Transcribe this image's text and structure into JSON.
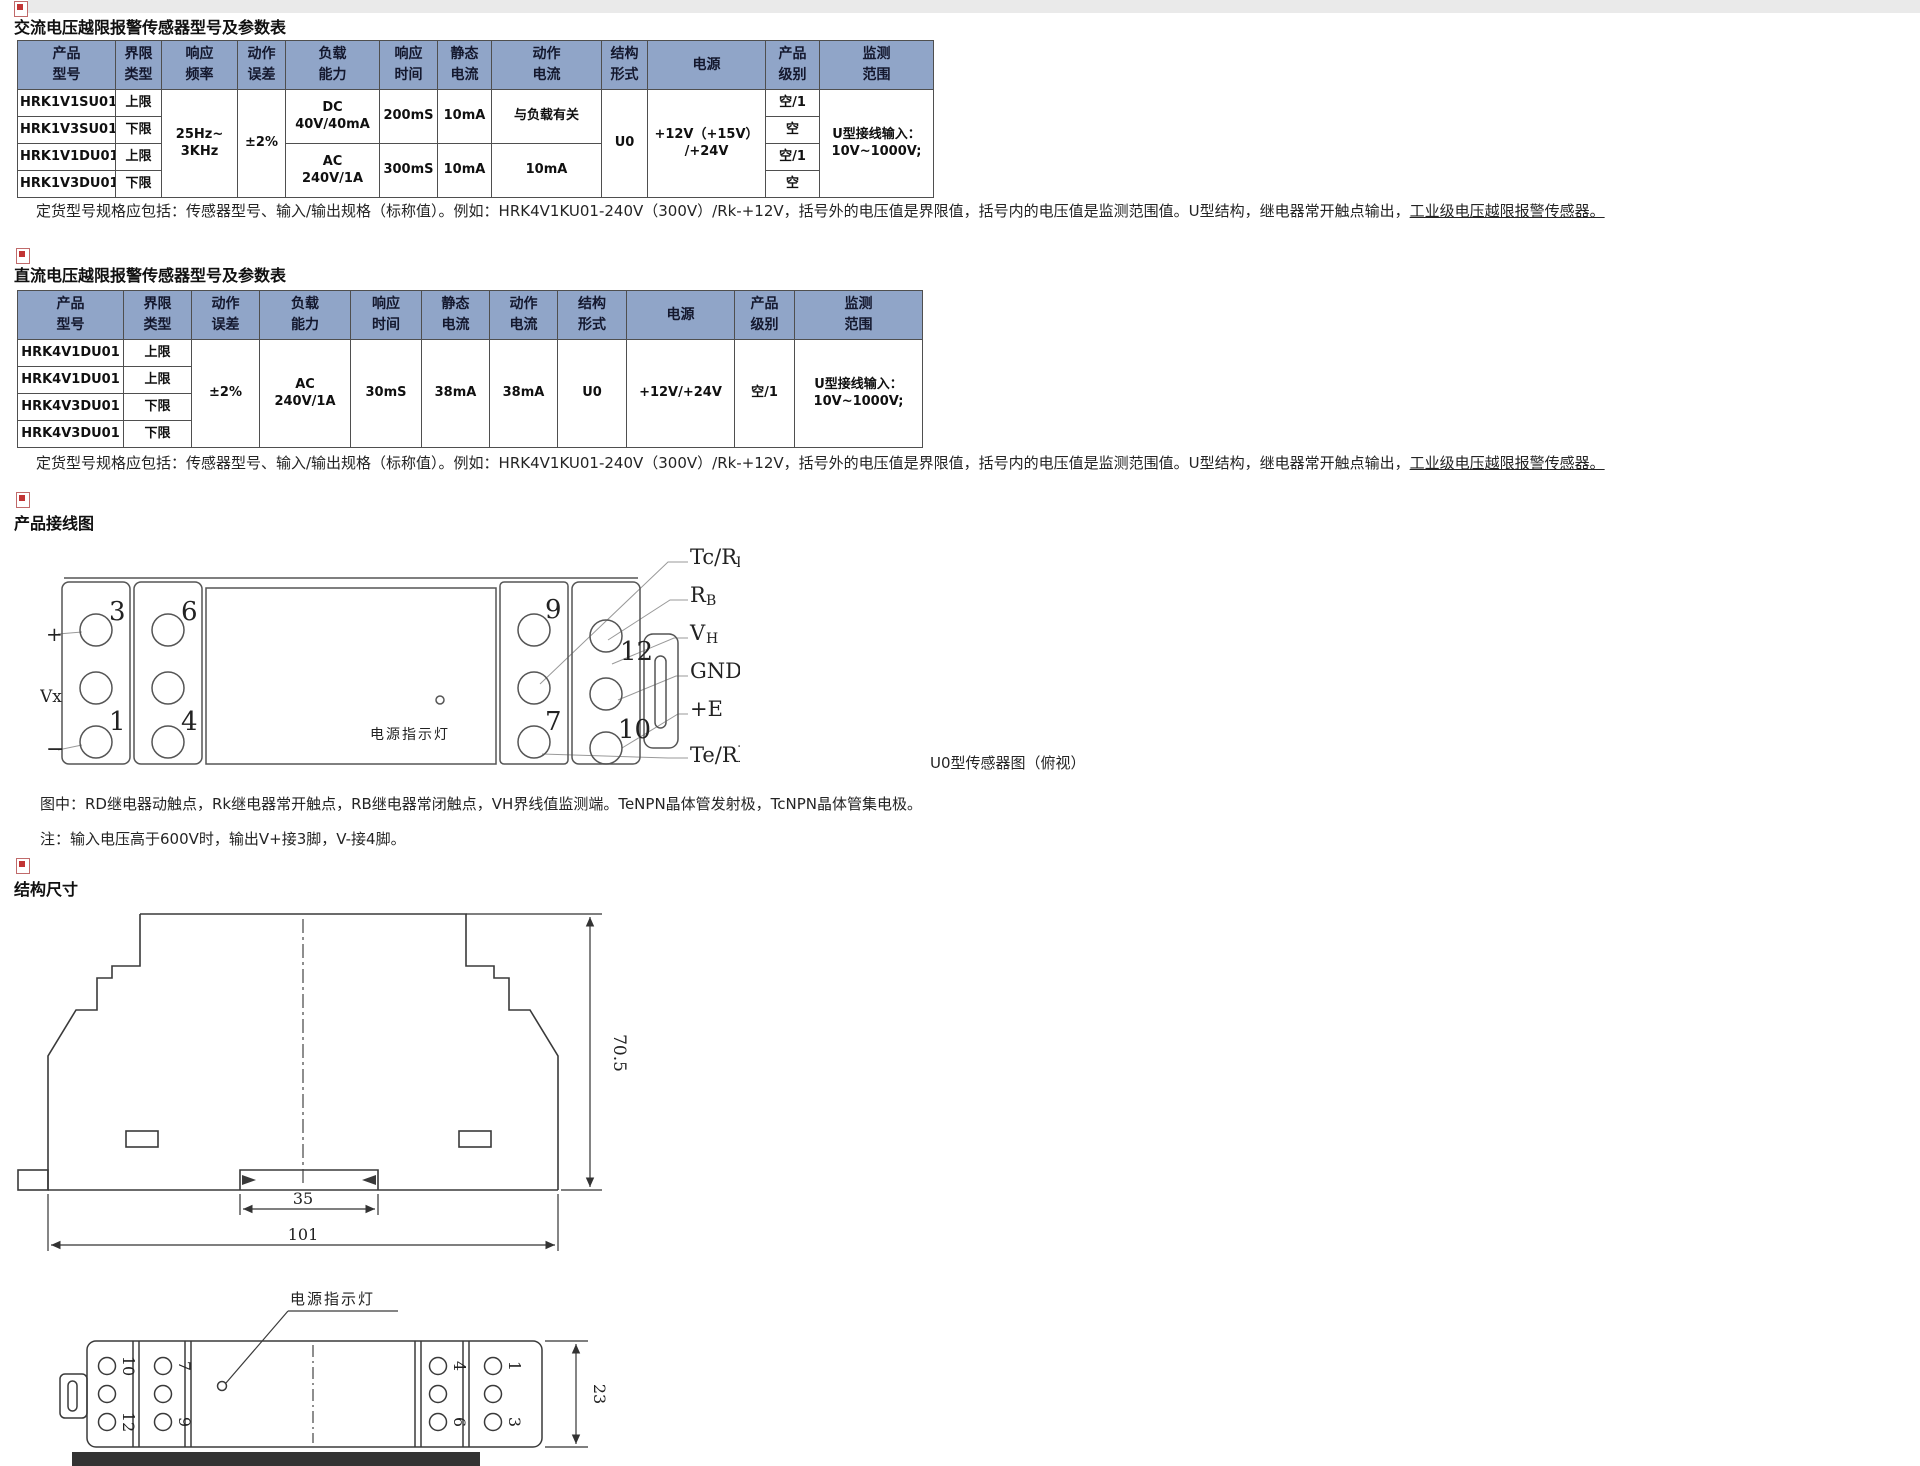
{
  "sections": {
    "ac": {
      "heading": "交流电压越限报警传感器型号及参数表",
      "table": {
        "header": [
          "产品\n型号",
          "界限\n类型",
          "响应\n频率",
          "动作\n误差",
          "负载\n能力",
          "响应\n时间",
          "静态\n电流",
          "动作\n电流",
          "结构\n形式",
          "电源",
          "产品\n级别",
          "监测\n范围"
        ],
        "rows": [
          [
            {
              "t": "HRK1V1SU01"
            },
            {
              "t": "上限"
            },
            {
              "t": "25Hz~\n3KHz",
              "rs": 4
            },
            {
              "t": "±2%",
              "rs": 4
            },
            {
              "t": "DC\n40V/40mA",
              "rs": 2
            },
            {
              "t": "200mS",
              "rs": 2
            },
            {
              "t": "10mA",
              "rs": 2
            },
            {
              "t": "与负载有关",
              "rs": 2
            },
            {
              "t": "U0",
              "rs": 4
            },
            {
              "t": "+12V（+15V）\n/+24V",
              "rs": 4
            },
            {
              "t": "空/1"
            },
            {
              "t": "U型接线输入：\n10V~1000V;",
              "rs": 4
            }
          ],
          [
            {
              "t": "HRK1V3SU01"
            },
            {
              "t": "下限"
            },
            {
              "t": "空"
            }
          ],
          [
            {
              "t": "HRK1V1DU01"
            },
            {
              "t": "上限"
            },
            {
              "t": "AC\n240V/1A",
              "rs": 2
            },
            {
              "t": "300mS",
              "rs": 2
            },
            {
              "t": "10mA",
              "rs": 2
            },
            {
              "t": "10mA",
              "rs": 2
            },
            {
              "t": "空/1"
            }
          ],
          [
            {
              "t": "HRK1V3DU01"
            },
            {
              "t": "下限"
            },
            {
              "t": "空"
            }
          ]
        ]
      },
      "note_main": "定货型号规格应包括：传感器型号、输入/输出规格（标称值）。例如：HRK4V1KU01-240V（300V）/Rk-+12V，括号外的电压值是界限值，括号内的电压值是监测范围值。U型结构，继电器常开触点输出，",
      "note_underline": "工业级电压越限报警传感器。"
    },
    "dc": {
      "heading": "直流电压越限报警传感器型号及参数表",
      "table": {
        "header": [
          "产品\n型号",
          "界限\n类型",
          "动作\n误差",
          "负载\n能力",
          "响应\n时间",
          "静态\n电流",
          "动作\n电流",
          "结构\n形式",
          "电源",
          "产品\n级别",
          "监测\n范围"
        ],
        "rows": [
          [
            {
              "t": "HRK4V1DU01"
            },
            {
              "t": "上限"
            },
            {
              "t": "±2%",
              "rs": 4
            },
            {
              "t": "AC\n240V/1A",
              "rs": 4
            },
            {
              "t": "30mS",
              "rs": 4
            },
            {
              "t": "38mA",
              "rs": 4
            },
            {
              "t": "38mA",
              "rs": 4
            },
            {
              "t": "U0",
              "rs": 4
            },
            {
              "t": "+12V/+24V",
              "rs": 4
            },
            {
              "t": "空/1",
              "rs": 4
            },
            {
              "t": "U型接线输入：\n10V~1000V;",
              "rs": 4
            }
          ],
          [
            {
              "t": "HRK4V1DU01"
            },
            {
              "t": "上限"
            }
          ],
          [
            {
              "t": "HRK4V3DU01"
            },
            {
              "t": "下限"
            }
          ],
          [
            {
              "t": "HRK4V3DU01"
            },
            {
              "t": "下限"
            }
          ]
        ]
      },
      "note_main": "定货型号规格应包括：传感器型号、输入/输出规格（标称值）。例如：HRK4V1KU01-240V（300V）/Rk-+12V，括号外的电压值是界限值，括号内的电压值是监测范围值。U型结构，继电器常开触点输出，",
      "note_underline": "工业级电压越限报警传感器。"
    },
    "wiring": {
      "heading": "产品接线图",
      "caption": "U0型传感器图（俯视）",
      "led_label": "电源指示灯",
      "side_labels": {
        "plus": "+",
        "vx": "Vx",
        "minus": "−"
      },
      "terminals": {
        "left_col1_top": "3",
        "left_col1_bottom": "1",
        "left_col2_top": "6",
        "left_col2_bottom": "4",
        "right_col1_top": "9",
        "right_col1_bottom": "7",
        "right_col2_top": "12",
        "right_col2_bottom": "10"
      },
      "pin_labels": [
        {
          "main": "Tc/R",
          "sub": "D"
        },
        {
          "main": "R",
          "sub": "B"
        },
        {
          "main": "V",
          "sub": "H"
        },
        {
          "main": "GND",
          "sub": ""
        },
        {
          "main": "+E",
          "sub": ""
        },
        {
          "main": "Te/Rk",
          "sub": ""
        }
      ],
      "legend": "图中：RD继电器动触点，Rk继电器常开触点，RB继电器常闭触点，VH界线值监测端。TeNPN晶体管发射极，TcNPN晶体管集电极。",
      "note": "注：输入电压高于600V时，输出V+接3脚，V-接4脚。"
    },
    "dims": {
      "heading": "结构尺寸",
      "height": "70.5",
      "rail_width": "35",
      "width": "101",
      "depth": "23",
      "led_label": "电源指示灯",
      "top_view_terminals": {
        "colA_top": "10",
        "colA_bottom": "12",
        "colB_top": "7",
        "colB_bottom": "9",
        "colC_top": "4",
        "colC_bottom": "6",
        "colD_top": "1",
        "colD_bottom": "3"
      }
    }
  }
}
